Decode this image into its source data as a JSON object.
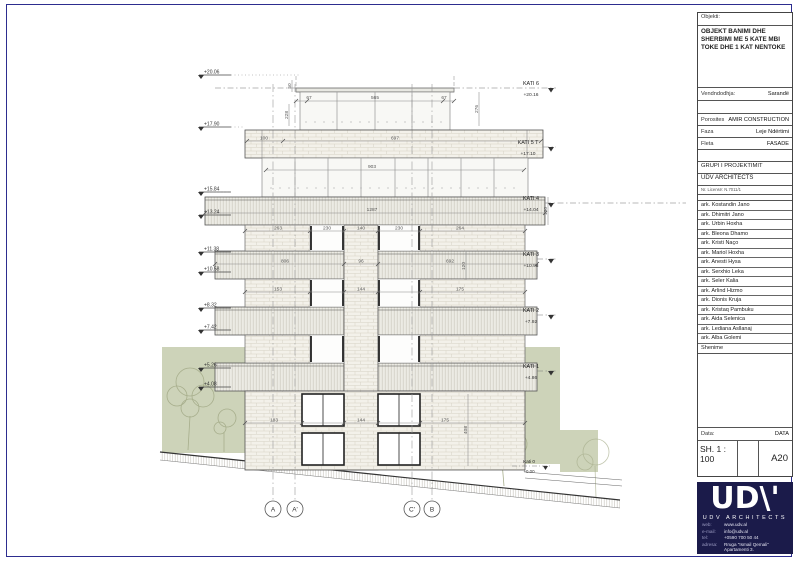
{
  "title_block": {
    "objekti_label": "Objekti:",
    "objekti_value": "OBJEKT BANIMI DHE SHERBIMI ME 5 KATE MBI TOKE DHE 1 KAT NENTOKE",
    "vendndodhja_label": "Vendndodhja:",
    "vendndodhja_value": "Sarandë",
    "porosites_label": "Porosites",
    "porosites_value": "AMIR CONSTRUCTION",
    "faza_label": "Faza",
    "faza_value": "Leje Ndërtimi",
    "fleta_label": "Fleta",
    "fleta_value": "FASADE",
    "grupi_label": "GRUPI I PROJEKTIMIT",
    "studio": "UDV ARCHITECTS",
    "license": "Nr. Licensë: N.7011/1",
    "architects": [
      "ark. Kostandin Jano",
      "ark. Dhimitri Jano",
      "ark. Urbin Hoxha",
      "ark. Bleona Dhamo",
      "ark. Kristi Naço",
      "ark. Mariol Hoxha",
      "ark. Anesti Hysa",
      "ark. Serxhio Leka",
      "ark. Seler Kalia",
      "ark. Arlind Hizmo",
      "ark. Dionis Kruja",
      "ark. Kristaq Pambuku",
      "ark. Aida Selenica",
      "ark. Lediana Asllanaj",
      "ark. Alba Golemi"
    ],
    "shenime_label": "Shenime",
    "data_label": "Data:",
    "data_value": "DATA",
    "scale": "SH. 1 : 100",
    "sheet_no": "A20"
  },
  "logo": {
    "wordmark": "UD\\'",
    "name": "UDV ARCHITECTS",
    "rows": [
      {
        "label": "web:",
        "value": "www.udv.al"
      },
      {
        "label": "e-mail:",
        "value": "info@udv.al"
      },
      {
        "label": "tel:",
        "value": "+0590 700 50 44"
      },
      {
        "label": "adresa:",
        "value": "Rruga \"Ismail Qemali\" Apartamenti 3."
      }
    ]
  },
  "drawing": {
    "floors": [
      {
        "name": "KATI 6",
        "elev": "+20.16"
      },
      {
        "name": "KATI 5 T",
        "elev": "+17.10"
      },
      {
        "name": "KATI 4",
        "elev": "+14.04"
      },
      {
        "name": "KATI 3",
        "elev": "+10.98"
      },
      {
        "name": "KATI 2",
        "elev": "+7.92"
      },
      {
        "name": "KATI 1",
        "elev": "+4.86"
      },
      {
        "name": "Kati 0",
        "elev": "+0.00"
      }
    ],
    "left_levels": [
      "+20.06",
      "+17.90",
      "+15.84",
      "+13.24",
      "+11.38",
      "+10.58",
      "+8.32",
      "+7.42",
      "+5.26",
      "+4.08"
    ],
    "axes": [
      "A",
      "A'",
      "C'",
      "B"
    ],
    "dims": {
      "v50": "50",
      "h67l": "67",
      "h565": "565",
      "h67r": "67",
      "v228": "228",
      "v276": "276",
      "h100": "100",
      "h697": "697",
      "h903": "903",
      "h1287": "1287",
      "v130": "130",
      "p263": "263",
      "p230l": "230",
      "p140": "140",
      "p230r": "230",
      "p264": "264",
      "s806": "806",
      "s96": "96",
      "s692": "692",
      "v120": "120",
      "q153": "153",
      "q144": "144",
      "q175": "175",
      "g183": "183",
      "g144": "144",
      "g175": "175",
      "v408": "408"
    }
  }
}
